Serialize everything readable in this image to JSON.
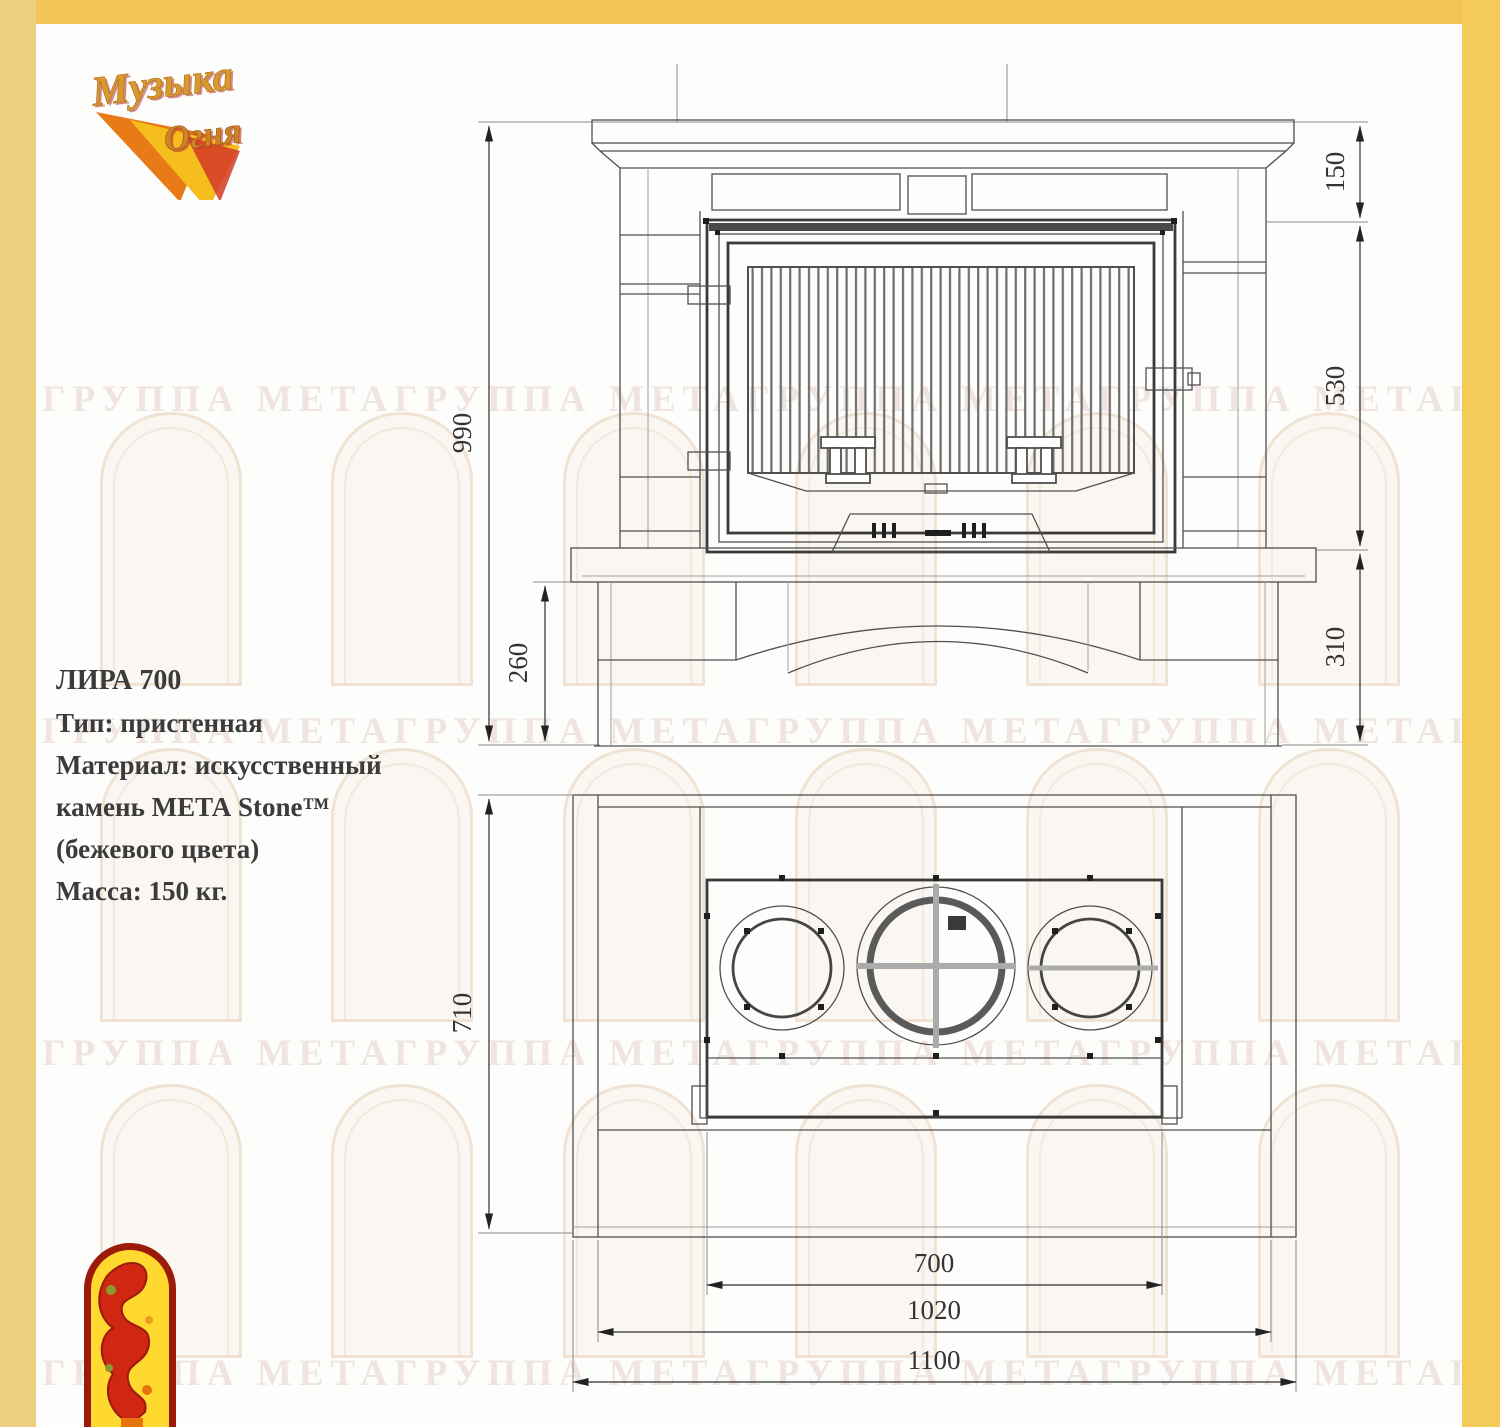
{
  "brand": {
    "line1": "Музыка",
    "line2": "Огня"
  },
  "specs": {
    "title": "ЛИРА 700",
    "lines": [
      "Тип: пристенная",
      "Материал: искусственный",
      "камень МЕТА Stone™",
      "(бежевого цвета)",
      "Масса: 150 кг."
    ]
  },
  "dims": {
    "front": {
      "overall_height": "990",
      "plinth_height": "260",
      "mantel_height": "150",
      "firebox_height": "530",
      "base_height": "310"
    },
    "plan": {
      "depth": "710",
      "firebox_width": "700",
      "body_width": "1020",
      "overall_width": "1100"
    }
  },
  "watermark": {
    "row_text": "ГРУППА МЕТАГРУППА МЕТАГРУППА МЕТАГРУППА МЕТАГРУППА МЕТА"
  }
}
